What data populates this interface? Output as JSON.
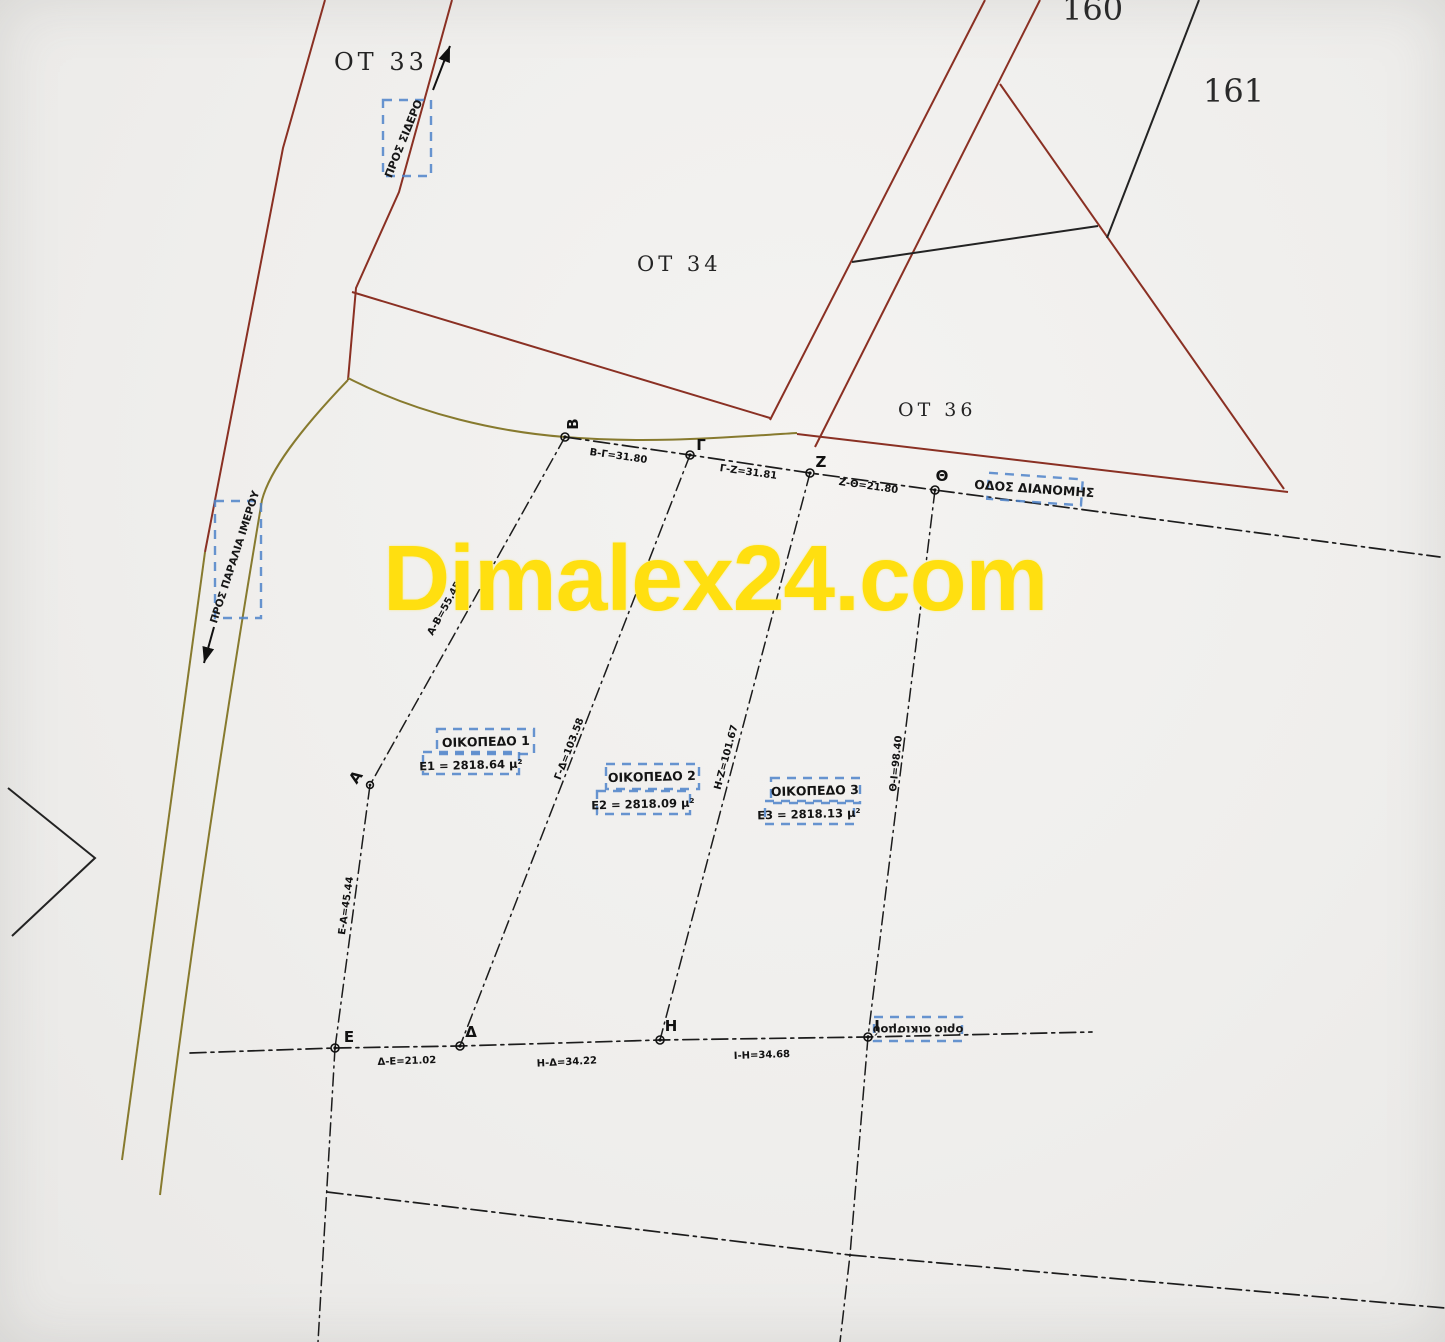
{
  "watermark": {
    "text": "Dimalex24.com"
  },
  "blocks": {
    "ot33": "OT 33",
    "ot34": "OT 34",
    "ot36": "OT 36",
    "b160": "160",
    "b161": "161"
  },
  "annotations": {
    "pros_sidero": "ΠΡΟΣ ΣΙΔΕΡΟ",
    "pros_paralia": "ΠΡΟΣ ΠΑΡΑΛΙΑ ΙΜΕΡΟΥ",
    "odos_dianomis": "ΟΔΟΣ ΔΙΑΝΟΜΗΣ",
    "orio_oikismou": "όριο οικισμού"
  },
  "parcels": [
    {
      "name": "ΟΙΚΟΠΕΔΟ 1",
      "area": "E1 = 2818.64 μ²"
    },
    {
      "name": "ΟΙΚΟΠΕΔΟ 2",
      "area": "E2 = 2818.09 μ²"
    },
    {
      "name": "ΟΙΚΟΠΕΔΟ 3",
      "area": "E3 = 2818.13 μ²"
    }
  ],
  "points": {
    "B": "B",
    "G": "Γ",
    "Z": "Z",
    "TH": "Θ",
    "A": "A",
    "E": "E",
    "D": "Δ",
    "H": "H",
    "I": "I"
  },
  "measurements": {
    "bg": "Β-Γ=31.80",
    "gz": "Γ-Ζ=31.81",
    "zth": "Ζ-Θ=21.80",
    "ab": "Α-Β=55.45",
    "ea": "Ε-Α=45.44",
    "gd": "Γ-Δ=103.58",
    "hz": "Η-Ζ=101.67",
    "thi": "Θ-Ι=98.40",
    "de": "Δ-Ε=21.02",
    "hd": "Η-Δ=34.22",
    "ih": "Ι-Η=34.68"
  },
  "colors": {
    "road_red": "#8a3023",
    "road_olive": "#877a2e",
    "line_black": "#1c1c1c",
    "annotation_blue": "#4d83c9",
    "watermark_yellow": "#ffdf10"
  }
}
